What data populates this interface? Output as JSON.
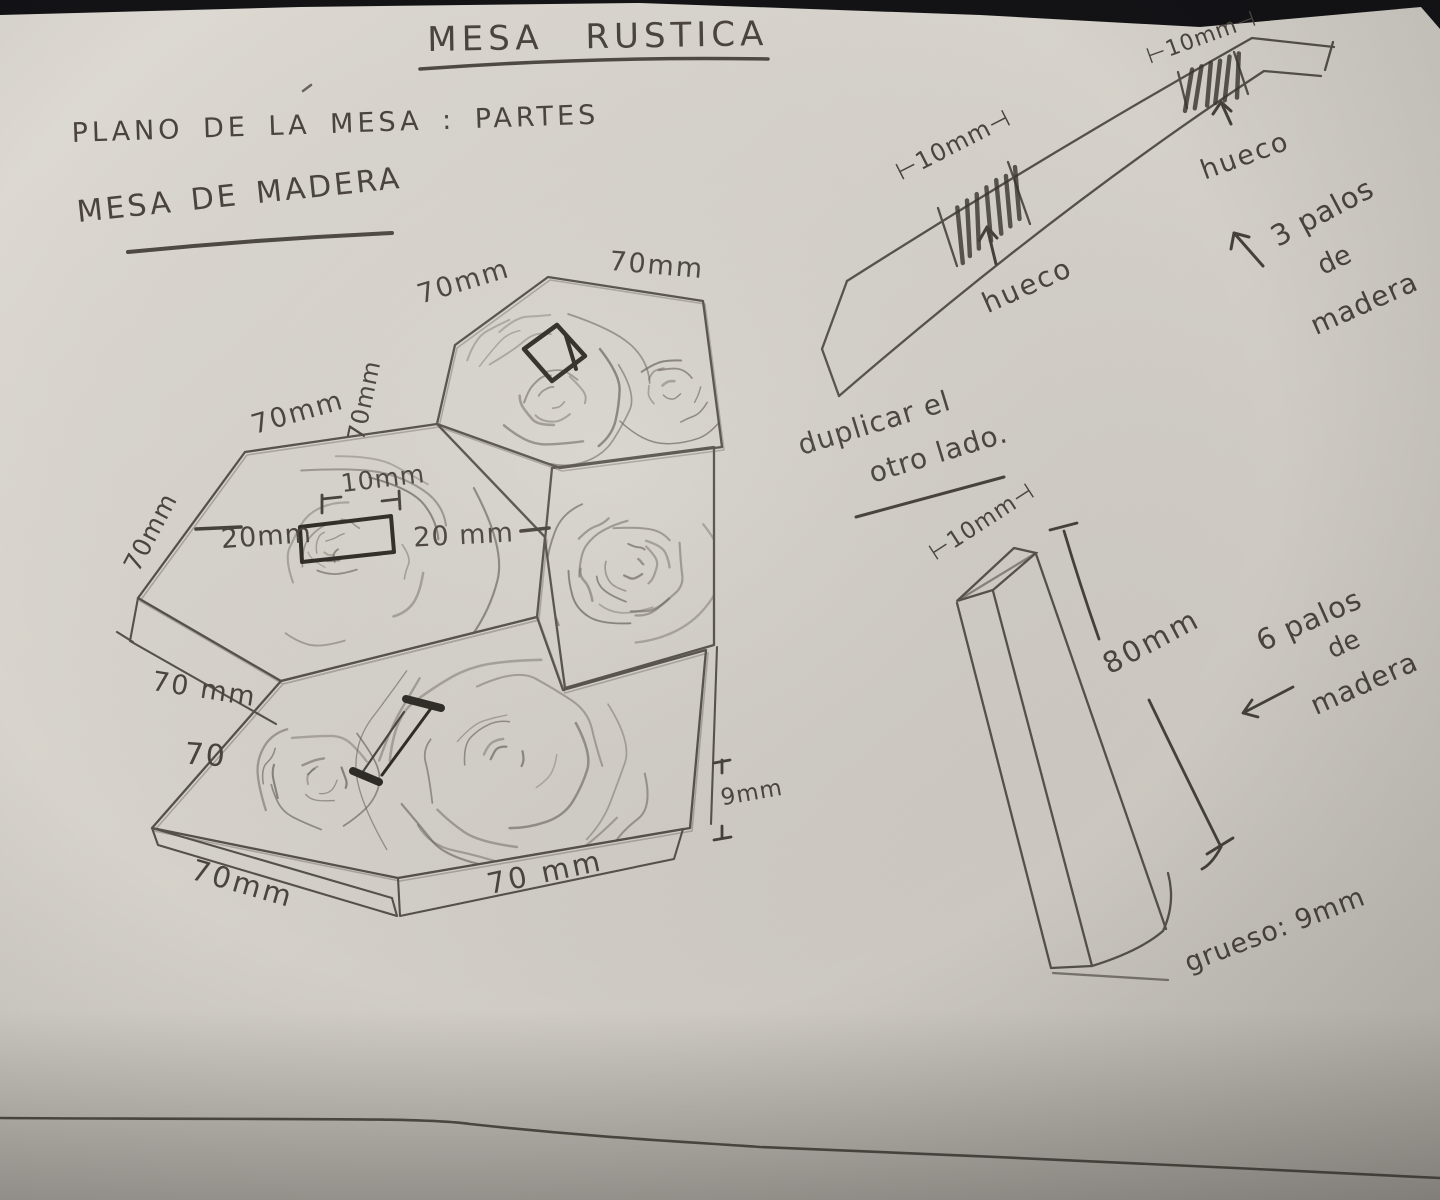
{
  "scene": {
    "description": "Photograph of a hand-drawn pencil plan on paper",
    "paper_color": "#d7d3cc",
    "pencil_color": "#55504a",
    "marker_color": "#2e2a25",
    "background_color": "#131316"
  },
  "header": {
    "title": "MESA RUSTICA",
    "subtitle": "PLANO DE LA MESA : PARTES",
    "material": "MESA DE MADERA"
  },
  "hex_cluster": {
    "dim_top_hex_top_left": "70mm",
    "dim_top_hex_top_right": "70mm",
    "dim_top_hex_left_side": "70mm",
    "dim_mid_hex_top": "70mm",
    "dim_mid_hex_left": "70mm",
    "dim_side_band": "70 mm",
    "dim_side_band_short": "70",
    "dim_bottom_left_edge": "70mm",
    "dim_bottom_right_edge": "70 mm",
    "dim_slot_width": "10mm",
    "dim_slot_left_offset": "20mm",
    "dim_slot_right_offset": "20 mm",
    "dim_thickness": "9mm"
  },
  "rail": {
    "dim_hole1": "⊢10mm⊣",
    "dim_hole2": "⊢10mm⊣",
    "hole1_label": "hueco",
    "hole2_label": "hueco",
    "note_line1": "3 palos",
    "note_line2": "de",
    "note_line3": "madera"
  },
  "duplicate_note": {
    "line1": "duplicar el",
    "line2": "otro lado."
  },
  "leg": {
    "dim_width": "⊢10mm⊣",
    "dim_length": "80mm",
    "note_line1": "6 palos",
    "note_line2": "de",
    "note_line3": "madera",
    "note_thickness": "grueso: 9mm"
  }
}
